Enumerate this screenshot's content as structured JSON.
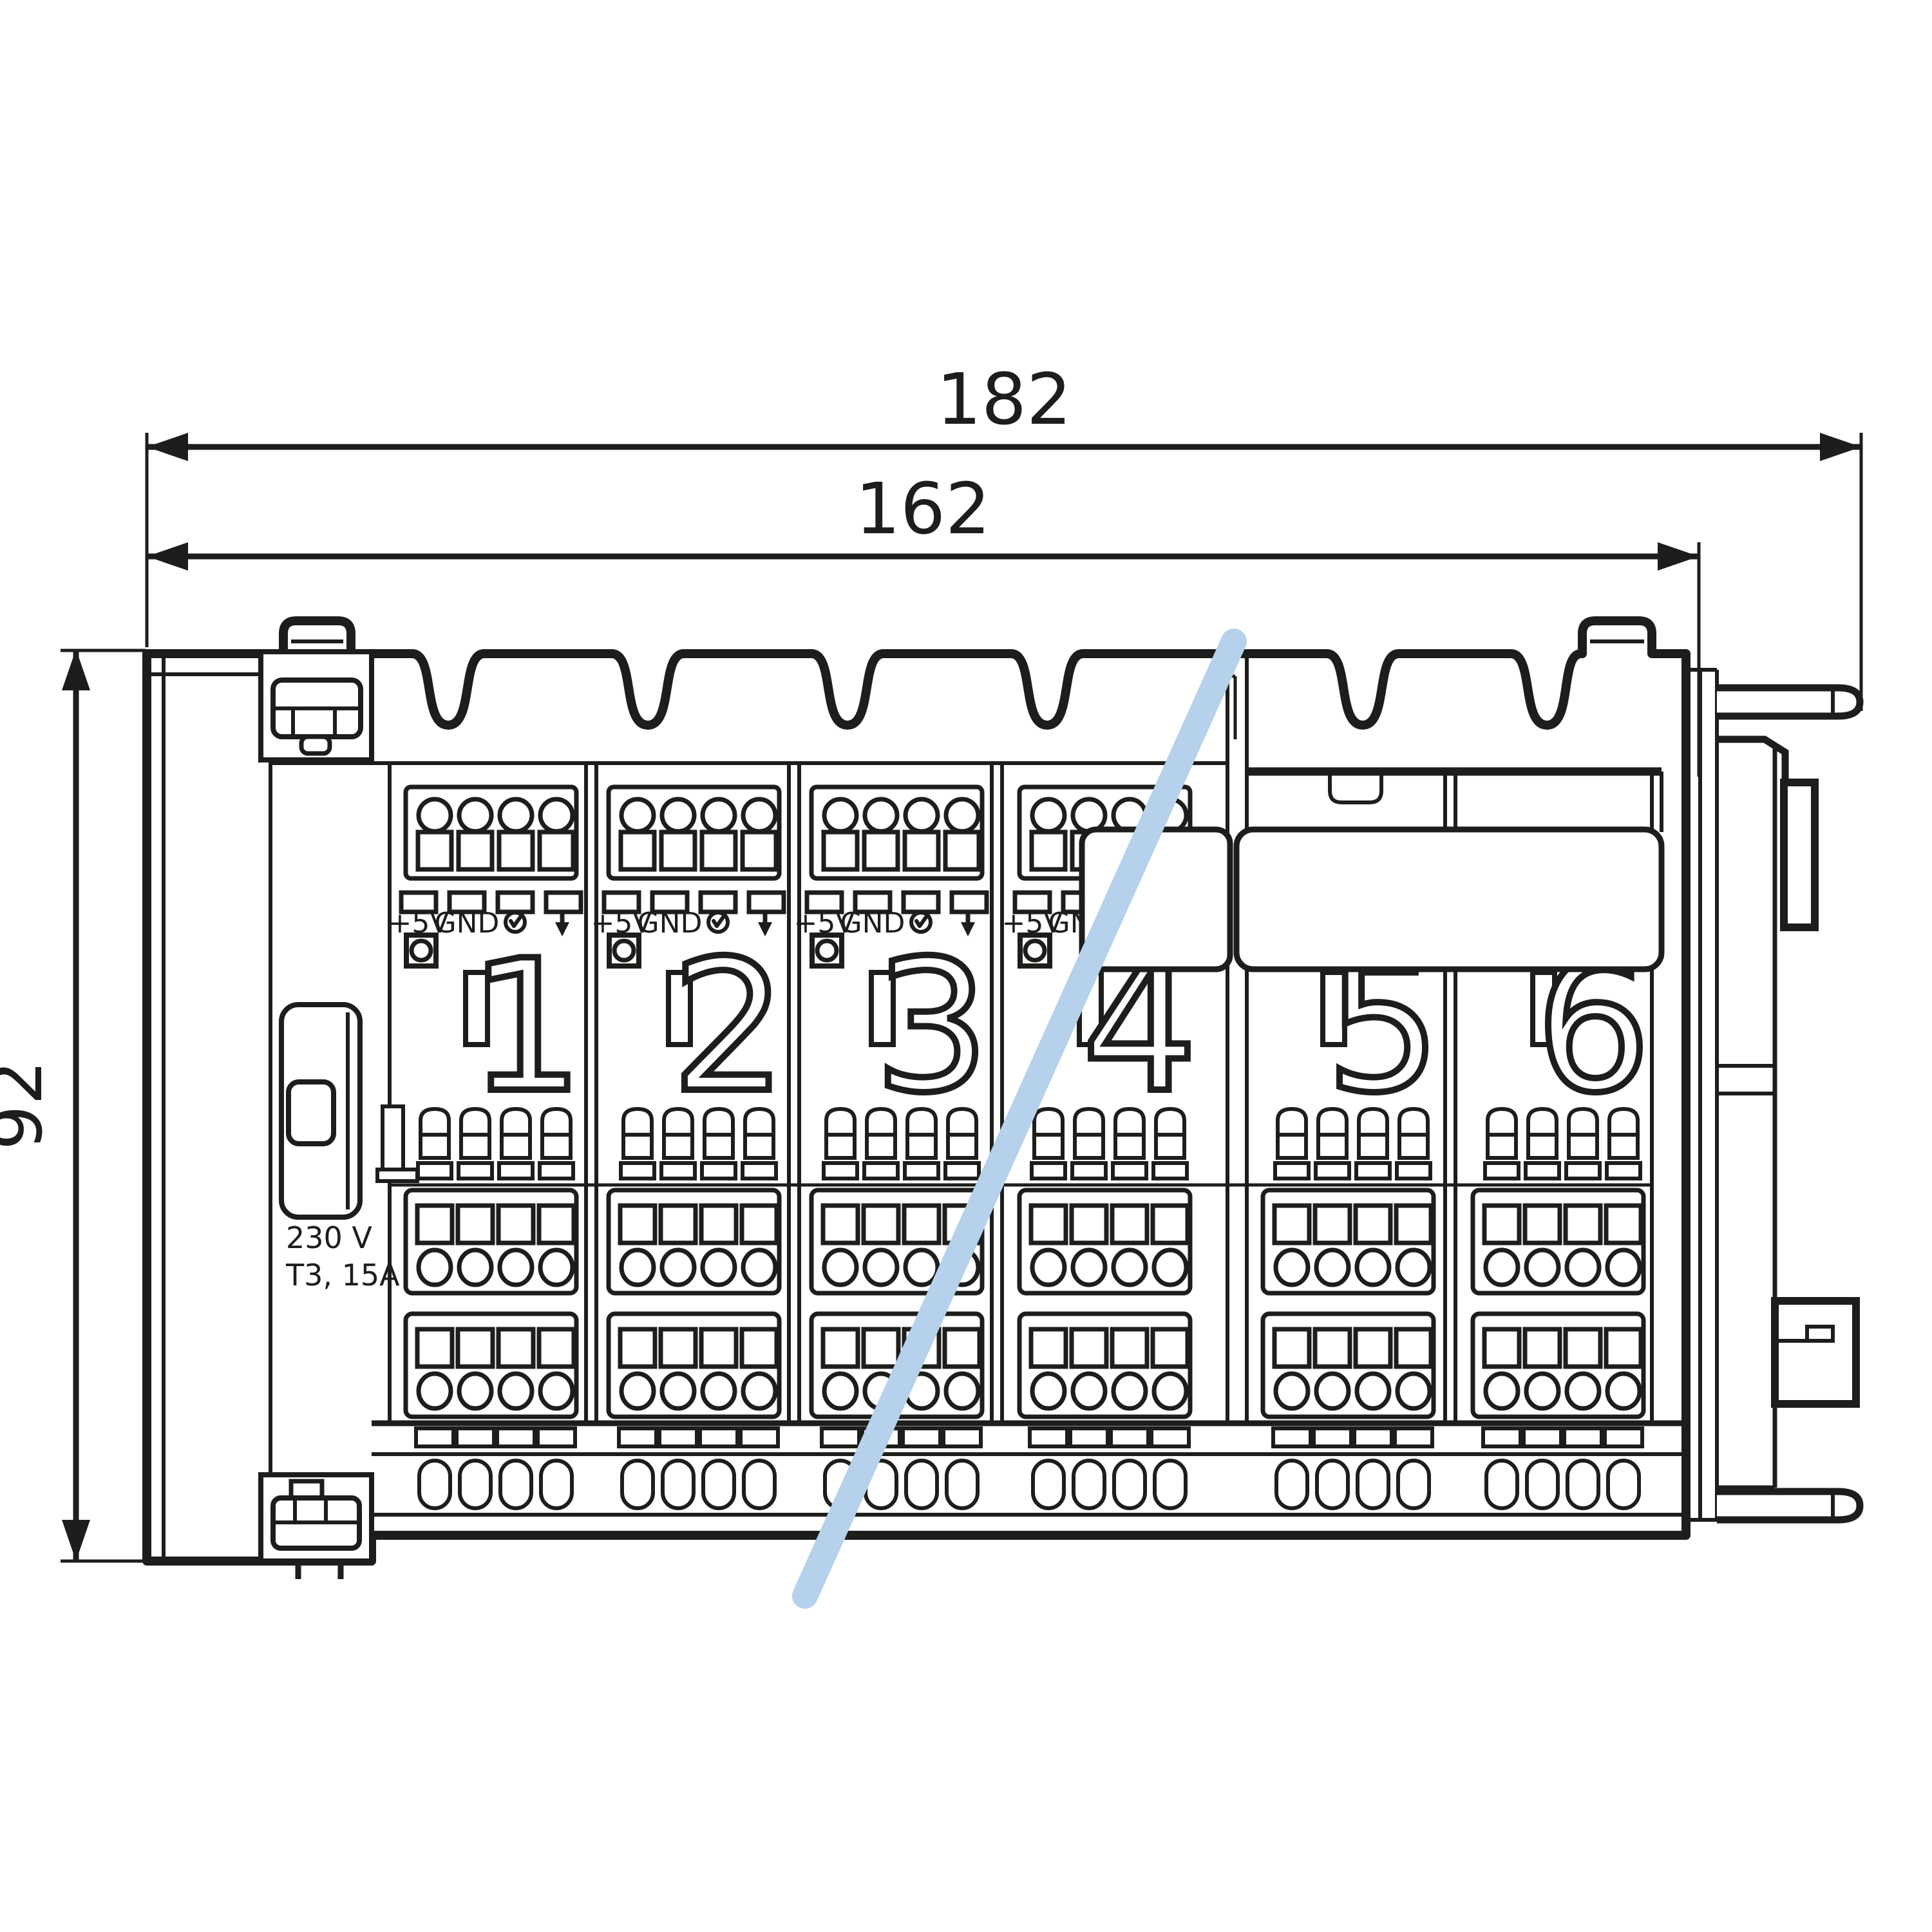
{
  "diagram": {
    "background": "#ffffff",
    "line_color": "#1d1d1b",
    "break_line_color": "#b5d1ec"
  },
  "dimensions": {
    "total_width": "182",
    "body_width": "162",
    "height": "92"
  },
  "device": {
    "fuse": {
      "line1": "230 V",
      "line2": "T3, 15A"
    },
    "terminal_labels": {
      "plus_5v": "+5V",
      "gnd": "GND"
    },
    "icons": {
      "status": "check-circle-icon",
      "actuator": "down-arrow-icon"
    },
    "zones": [
      "1",
      "2",
      "3",
      "4",
      "5",
      "6"
    ]
  }
}
